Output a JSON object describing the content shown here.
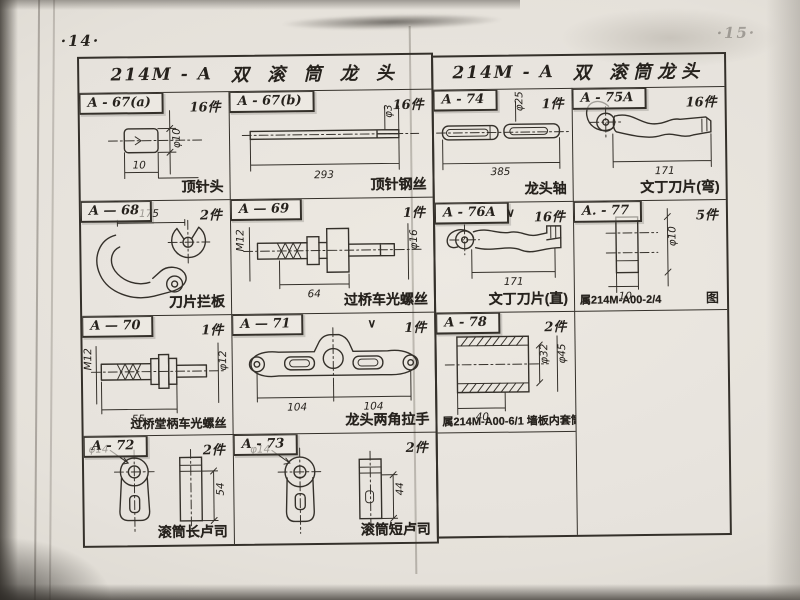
{
  "photo": {
    "left_page_number": "·14·",
    "right_page_number": "·15·"
  },
  "left_sheet": {
    "title_code": "214M - A",
    "title_name": "双 滚 筒 龙 头",
    "cells": [
      {
        "tag": "A - 67(a)",
        "qty": "16件",
        "caption": "顶针头",
        "dims": [
          "φ10",
          "10"
        ]
      },
      {
        "tag": "A - 67(b)",
        "qty": "16件",
        "caption": "顶针钢丝",
        "dims": [
          "φ3",
          "293"
        ]
      },
      {
        "tag": "A — 68",
        "qty": "2件",
        "caption": "刀片拦板",
        "dims": [
          "175"
        ]
      },
      {
        "tag": "A — 69",
        "qty": "1件",
        "caption": "过桥车光螺丝",
        "dims": [
          "M12",
          "φ16",
          "64"
        ]
      },
      {
        "tag": "A — 70",
        "qty": "1件",
        "caption": "过桥堂柄车光螺丝",
        "dims": [
          "M12",
          "φ12",
          "55"
        ]
      },
      {
        "tag": "A — 71",
        "qty": "1件",
        "caption": "龙头两角拉手",
        "dims": [
          "104",
          "104"
        ],
        "finish_mark": "∨"
      },
      {
        "tag": "A - 72",
        "qty": "2件",
        "caption": "滚筒长卢司",
        "dims": [
          "φ14",
          "54"
        ]
      },
      {
        "tag": "A - 73",
        "qty": "2件",
        "caption": "滚筒短卢司",
        "dims": [
          "φ14",
          "44"
        ]
      }
    ]
  },
  "right_sheet": {
    "title_code": "214M - A",
    "title_name": "双 滚筒龙头",
    "cells": [
      {
        "tag": "A - 74",
        "qty": "1件",
        "caption": "龙头轴",
        "dims": [
          "φ25",
          "385"
        ]
      },
      {
        "tag": "A - 75A",
        "qty": "16件",
        "caption": "文丁刀片(弯)",
        "dims": [
          "171"
        ]
      },
      {
        "tag": "A - 76A",
        "qty": "16件",
        "caption": "文丁刀片(直)",
        "dims": [
          "171"
        ],
        "finish_mark": "∨"
      },
      {
        "tag": "A. - 77",
        "qty": "5件",
        "caption": "属214M-A00-2/4",
        "note": "图",
        "dims": [
          "φ10",
          "10"
        ]
      },
      {
        "tag": "A - 78",
        "qty": "2件",
        "caption": "属214M-A00-6/1 墙板内套筒",
        "dims": [
          "φ32",
          "φ45",
          "40"
        ]
      }
    ]
  }
}
